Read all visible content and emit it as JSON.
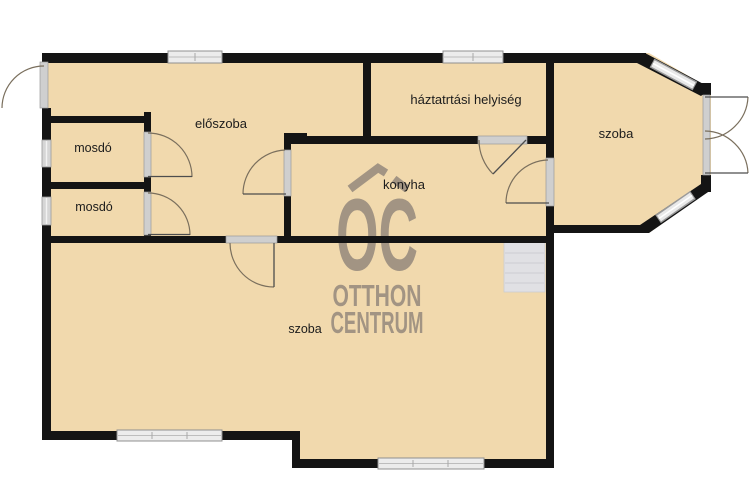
{
  "document": {
    "kind": "floor-plan"
  },
  "rooms": [
    {
      "id": "eloszoba",
      "label": "előszoba"
    },
    {
      "id": "mosdo-upper",
      "label": "mosdó"
    },
    {
      "id": "mosdo-lower",
      "label": "mosdó"
    },
    {
      "id": "haztartasi-helyiseg",
      "label": "háztatrtási helyiség"
    },
    {
      "id": "konyha",
      "label": "konyha"
    },
    {
      "id": "szoba-bay",
      "label": "szoba"
    },
    {
      "id": "szoba-large",
      "label": "szoba"
    }
  ],
  "watermark": {
    "monogram": "OC",
    "name_top": "OTTHON",
    "name_bottom": "CENTRUM"
  },
  "colors": {
    "background": "#ffffff",
    "floor": "#f1d9ad",
    "wall": "#141414",
    "window": "#e9e9e9",
    "watermark": "#9e9181",
    "label_text": "#1c1c1c"
  }
}
